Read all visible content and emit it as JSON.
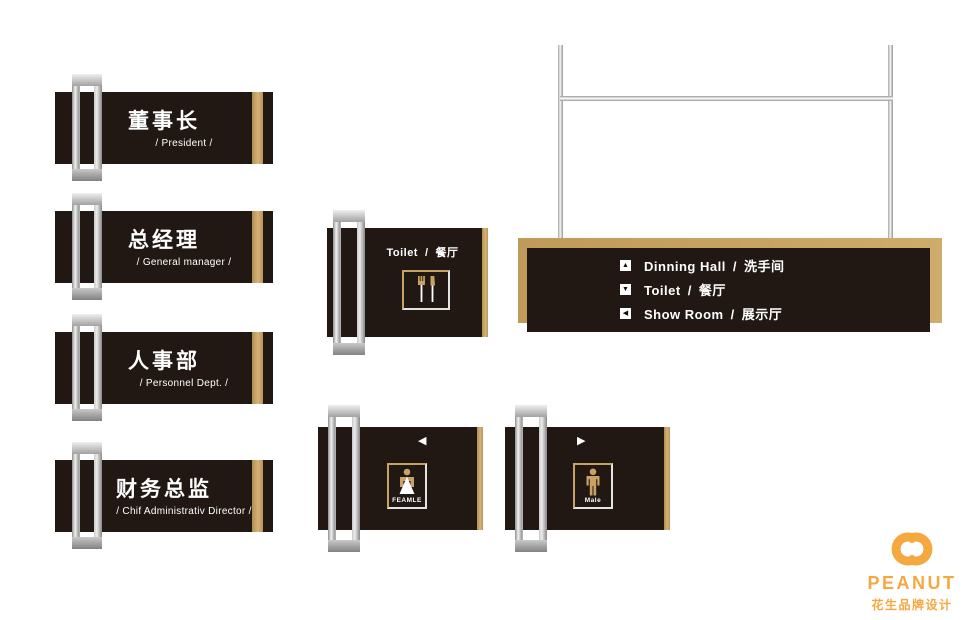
{
  "colors": {
    "panel_dark": "#211813",
    "gold": "#c8a264",
    "logo_orange": "#f6a840",
    "text_white": "#ffffff"
  },
  "office_signs": [
    {
      "title": "董事长",
      "subtitle": "/ President /"
    },
    {
      "title": "总经理",
      "subtitle": "/ General manager /"
    },
    {
      "title": "人事部",
      "subtitle": "/ Personnel Dept. /"
    },
    {
      "title": "财务总监",
      "subtitle": "/ Chif Administrativ Director /"
    }
  ],
  "dining_sign": {
    "label_en": "Toilet",
    "sep": "/",
    "label_zh": "餐厅"
  },
  "directory_sign": {
    "items": [
      {
        "arrow": "▲",
        "label_en": "Dinning Hall",
        "sep": "/",
        "label_zh": "洗手间"
      },
      {
        "arrow": "▼",
        "label_en": "Toilet",
        "sep": "/",
        "label_zh": "餐厅"
      },
      {
        "arrow": "◀",
        "label_en": "Show Room",
        "sep": "/",
        "label_zh": "展示厅"
      }
    ]
  },
  "restroom_signs": [
    {
      "arrow": "◀",
      "label": "FEAMLE"
    },
    {
      "arrow": "▶",
      "label": "Male"
    }
  ],
  "logo": {
    "name": "PEANUT",
    "tagline": "花生品牌设计"
  }
}
